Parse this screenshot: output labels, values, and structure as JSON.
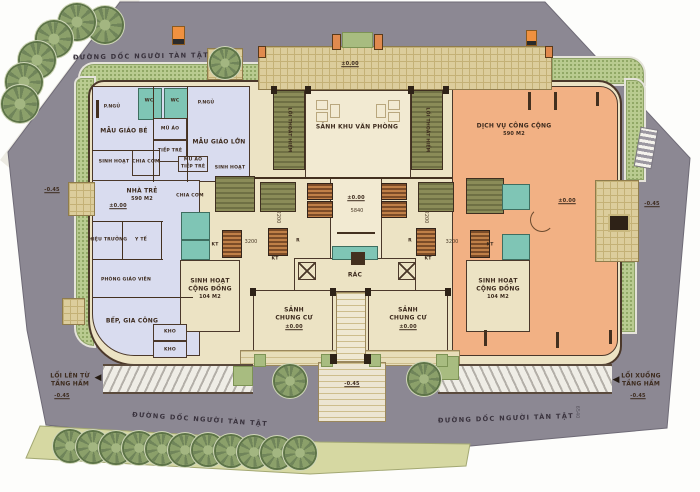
{
  "plan": {
    "road_label": "ĐƯỜNG DỐC NGƯỜI TÀN TẬT",
    "levels": {
      "zero": "±0.00",
      "minus045": "-0.45"
    },
    "zones": {
      "kindergarten_small": "MẪU GIÁO BÉ",
      "kindergarten_large": "MẪU GIÁO LỚN",
      "nursery": "NHÀ TRẺ",
      "nursery_area": "590 M2",
      "public_service": "DỊCH VỤ CÔNG CỘNG",
      "public_service_area": "590 M2",
      "office_lobby": "SẢNH KHU VĂN PHÒNG",
      "apartment_lobby_1": "SẢNH",
      "apartment_lobby_2": "CHUNG CƯ",
      "community_1": "SINH HOẠT",
      "community_2": "CỘNG ĐỒNG",
      "community_area": "104 M2",
      "trash": "RÁC",
      "escape": "LỐI THOÁT HIỂM"
    },
    "rooms": {
      "bedroom": "P.NGỦ",
      "wc": "WC",
      "hats": "MŨ ÁO",
      "child_reception": "TIẾP TRẺ",
      "activity": "SINH HOẠT",
      "meal_split": "CHIA CƠM",
      "principal": "HIỆU TRƯỞNG",
      "medical": "Y TẾ",
      "teachers_room": "PHÒNG GIÁO VIÊN",
      "kitchen": "BẾP, GIA CÔNG",
      "storage": "KHO",
      "technical": "KT",
      "riser": "R"
    },
    "basement": {
      "up_1": "LỐI LÊN TỪ",
      "up_2": "TẦNG HẦM",
      "down_1": "LỐI XUỐNG",
      "down_2": "TẦNG HẦM"
    },
    "dims": {
      "d2200": "2200",
      "d3200": "3200",
      "d5840": "5840",
      "d6540": "6540"
    },
    "icons": {
      "arrow_left": "◀"
    },
    "colors": {
      "road": "#8c8893",
      "wall": "#4b382a",
      "nursery_fill": "#d9dcef",
      "service_fill": "#f2b184",
      "core_fill": "#ece3c4",
      "stair": "#8b8c58",
      "wet_room": "#7fc5b5",
      "paving": "#dccd9c",
      "green_band": "#b9cb90",
      "grass": "#d6d8a2",
      "elevator": "#c08048"
    }
  }
}
